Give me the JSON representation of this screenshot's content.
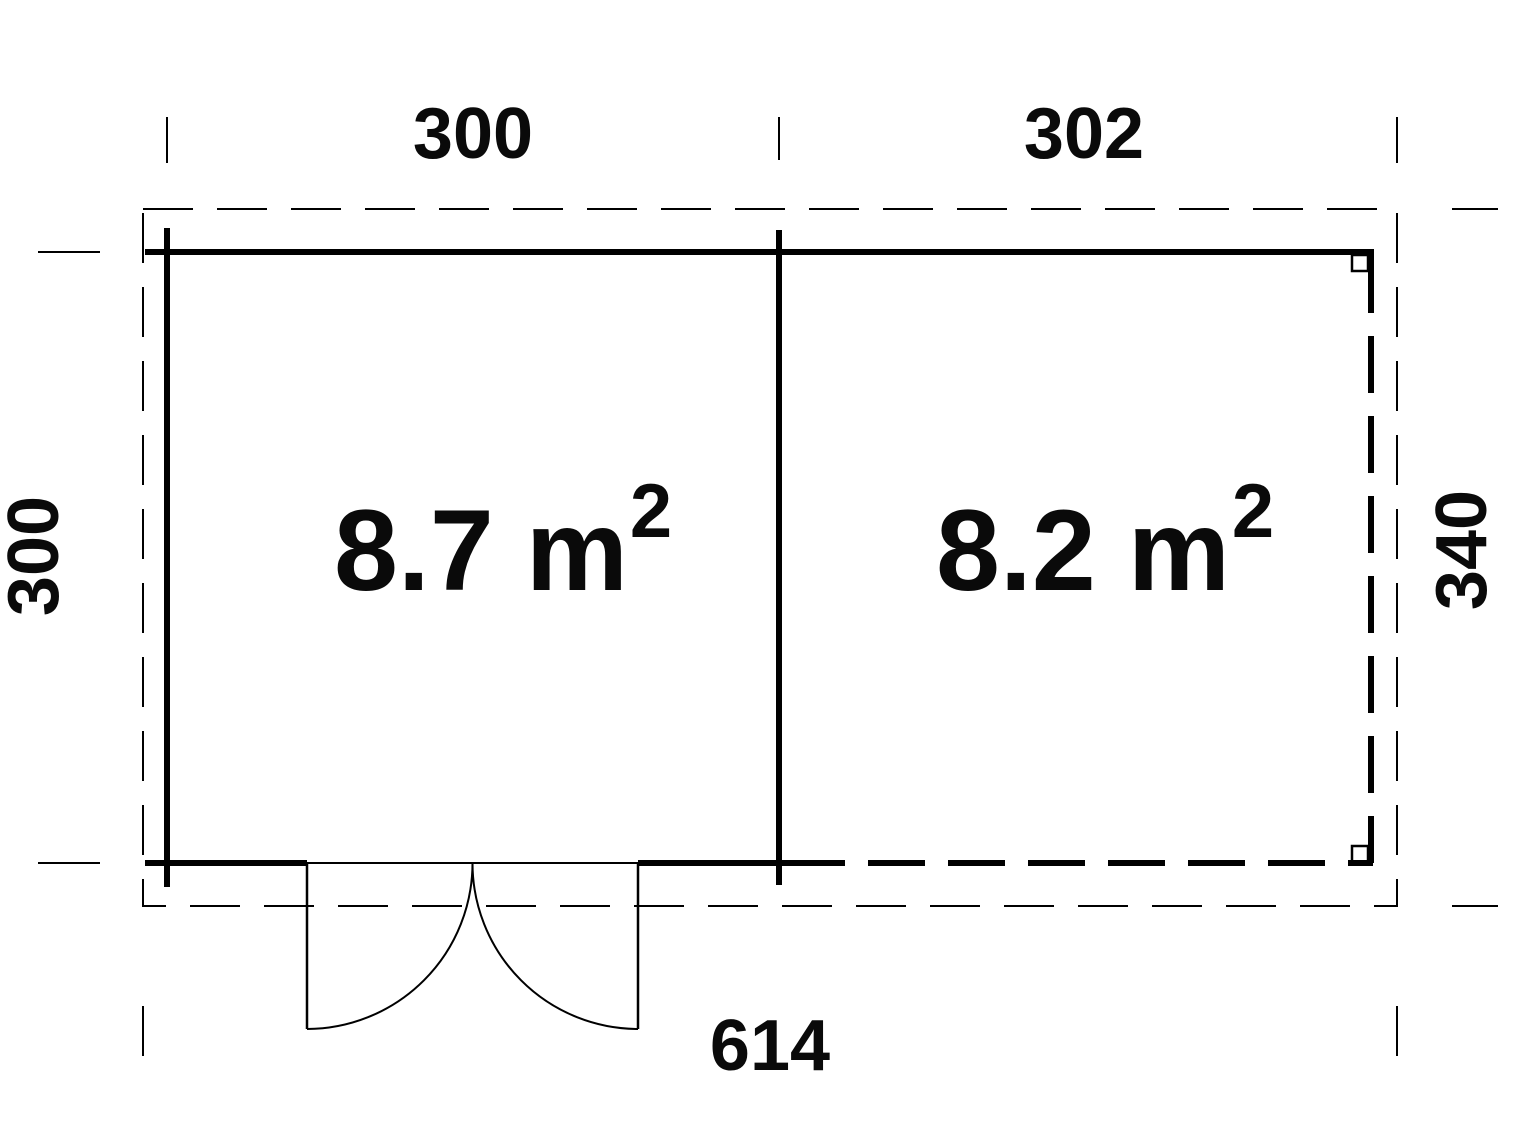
{
  "plan": {
    "dimensions": {
      "top_left": "300",
      "top_right": "302",
      "left": "300",
      "right": "340",
      "bottom": "614"
    },
    "rooms": [
      {
        "area": "8.7 m",
        "exponent": "2"
      },
      {
        "area": "8.2 m",
        "exponent": "2"
      }
    ]
  }
}
